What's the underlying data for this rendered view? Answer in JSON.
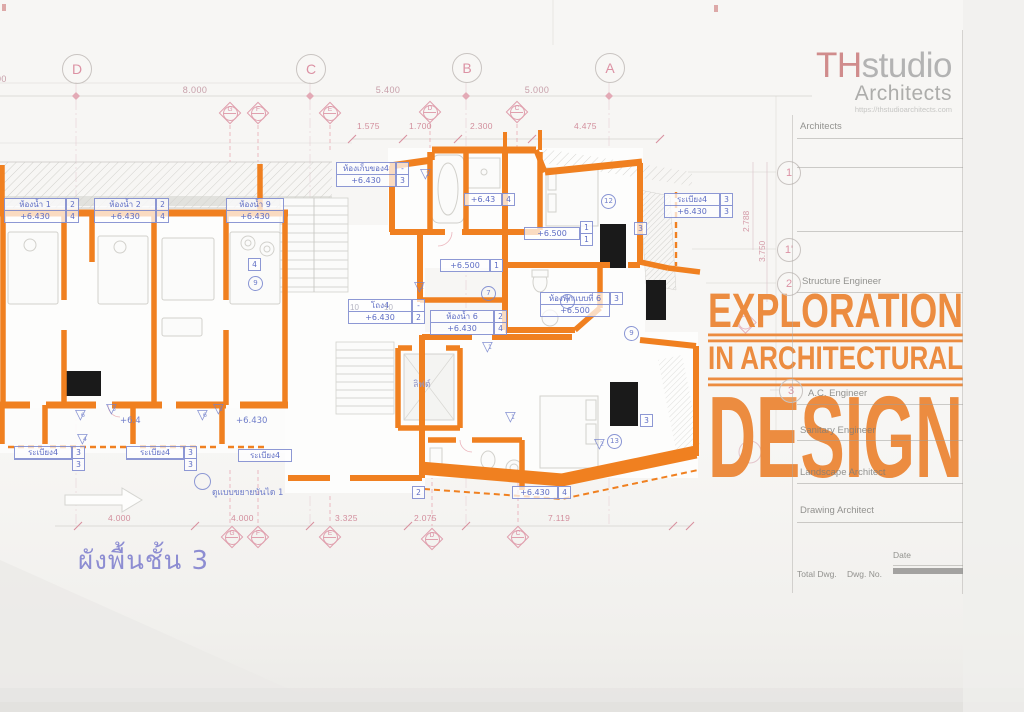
{
  "logo": {
    "th": "TH",
    "studio": "studio",
    "architects": "Architects",
    "url": "https://thstudioarchitects.com"
  },
  "headline": {
    "l1": "EXPLORATION",
    "l2": "IN ARCHITECTURAL",
    "l3": "DESIGN",
    "color": "#ec8c40"
  },
  "plan_title": "ผังพื้นชั้น 3",
  "grid": {
    "top_bubbles": [
      "D",
      "C",
      "B",
      "A"
    ],
    "right_bubbles": [
      "1",
      "1'",
      "2",
      "3"
    ],
    "top_dims": [
      "8.000",
      "5.400",
      "5.000"
    ],
    "top_dim_partial": "00",
    "sub_dims": [
      "1.575",
      "1.700",
      "2.300",
      "4.475"
    ],
    "bottom_dims": [
      "4.000",
      "4.000",
      "3.325",
      "2.075",
      "7.119"
    ],
    "right_dims": [
      "2.788",
      "3.750"
    ],
    "door_tags_top": [
      "G",
      "F",
      "E",
      "D",
      "C"
    ],
    "door_tags_bottom": [
      "G",
      "F",
      "E",
      "D",
      "C"
    ]
  },
  "rooms": [
    {
      "name": "ห้องน้ำ 1",
      "elev": "+6.430",
      "t1": "2",
      "t2": "4"
    },
    {
      "name": "ห้องน้ำ 2",
      "elev": "+6.430",
      "t1": "2",
      "t2": "4"
    },
    {
      "name": "ห้องน้ำ 9",
      "elev": "+6.430",
      "t1": "4",
      "t2": "9"
    },
    {
      "name": "ห้องเก็บของ4",
      "elev": "+6.430",
      "t1": "-",
      "t2": "3"
    },
    {
      "name": "โถง4",
      "elev": "+6.430",
      "t1": "-",
      "t2": "2"
    },
    {
      "name": "ห้องน้ำ 6",
      "elev": "+6.430",
      "t1": "2",
      "t2": "4"
    },
    {
      "name": "ห้องพักแบบที่ 6",
      "elev": "+6.500",
      "t1": "3"
    },
    {
      "name": "ระเบียง4",
      "elev": "",
      "t1": "3",
      "t2": "3"
    },
    {
      "name": "ระเบียง4",
      "elev": "",
      "t1": "3",
      "t2": "3"
    },
    {
      "name": "ระเบียง4"
    },
    {
      "name": "ระเบียง4",
      "elev": "+6.430",
      "t1": "3",
      "t2": "3"
    },
    {
      "name": "+6.500",
      "t1": "1",
      "t2": "1"
    },
    {
      "name": "+6.43",
      "t1": "4"
    },
    {
      "name": "+6.430",
      "t1": "4"
    },
    {
      "name": "+6.500",
      "t1": "1"
    }
  ],
  "notes": {
    "stair_detail": "ดูแบบขยายบันได 1",
    "lift": "ลิฟต์",
    "elev_plain_1": "+6.430",
    "elev_plain_2": "+6.4",
    "gray_1": "10",
    "gray_2": "10"
  },
  "tags": {
    "triangles": [
      "2",
      "1",
      "1",
      "2",
      "6",
      "3",
      "4",
      "6",
      "3",
      "2"
    ],
    "circles": [
      "7",
      "7",
      "9",
      "12",
      "13",
      "9"
    ],
    "squares": [
      "4",
      "3",
      "3",
      "2"
    ]
  },
  "titleblock": {
    "labels": [
      "Architects",
      "Structure Engineer",
      "A.C. Engineer",
      "Sanitary Engineer",
      "Landscape Architect",
      "Drawing Architect"
    ],
    "date": "Date",
    "total": "Total Dwg.",
    "dwg_no": "Dwg. No."
  },
  "colors": {
    "wall_orange": "#f08020",
    "headline_orange": "#ec8c40",
    "annotation_pink": "#e09aae",
    "label_blue": "#6e7cc9",
    "thai_title": "#8d8dd2"
  }
}
